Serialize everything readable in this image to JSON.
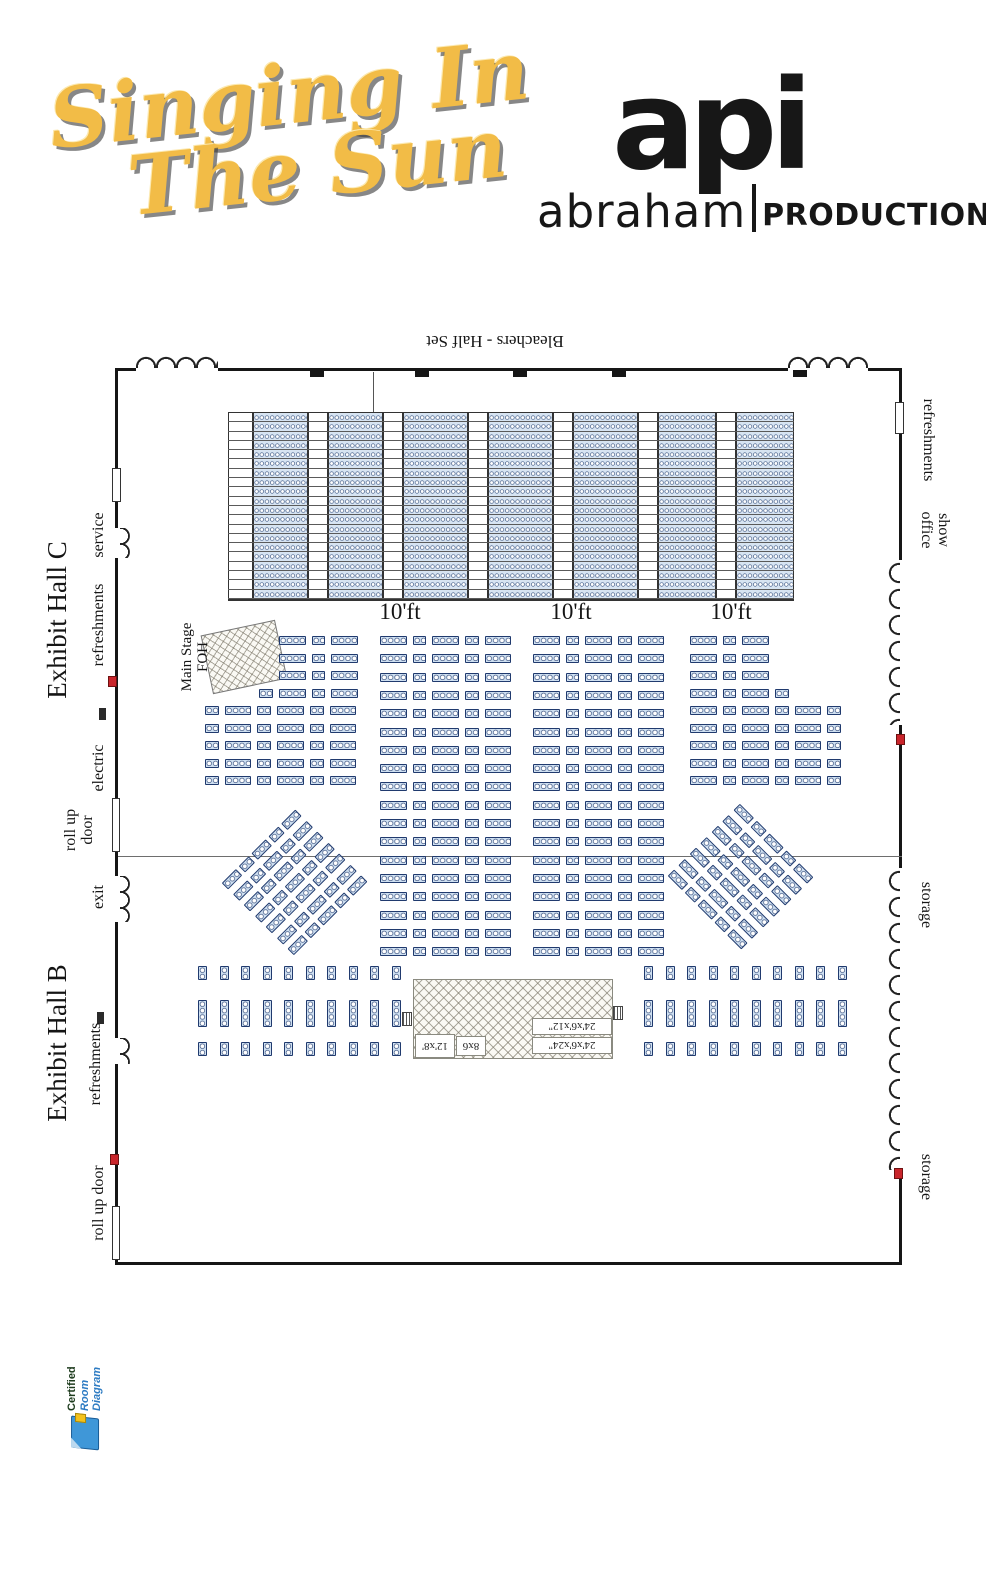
{
  "header": {
    "title1": "Singing In",
    "title2": "The Sun",
    "api": "api",
    "abraham": "abraham",
    "productions": "PRODUCTIONS"
  },
  "plan": {
    "bleachers_label": "Bleachers - Half Set",
    "aisles": [
      "10'ft",
      "10'ft",
      "10'ft"
    ],
    "halls": {
      "c": "Exhibit Hall C",
      "b": "Exhibit Hall B"
    },
    "left": {
      "service": "service",
      "refreshments_c": "refreshments",
      "electric": "electric",
      "rollup_c1": "roll up",
      "rollup_c2": "door",
      "exit": "exit",
      "refreshments_b": "refreshments",
      "rollup_b": "roll up door"
    },
    "right": {
      "refreshments": "refreshments",
      "show": "show",
      "office": "office",
      "storage1": "storage",
      "storage2": "storage"
    },
    "foh1": "Main Stage",
    "foh2": "FOH",
    "stage": {
      "s1": "24'x6'x12\"",
      "s2": "24'x6'x24\"",
      "s3": "8x6",
      "s4": "12'x8'"
    }
  },
  "badge": {
    "l1": "Certified",
    "l2": "Room Diagram"
  },
  "colors": {
    "gold": "#f2bc47",
    "logo_black": "#171717",
    "seat_fill": "#cfe0f1",
    "seat_line": "#203a6e",
    "wall": "#161616",
    "red_marker": "#c9252b",
    "badge_blue": "#2e7cc3"
  },
  "seating": {
    "pitch": 6.4,
    "bleachers": {
      "x": 228,
      "y": 412,
      "w": 566,
      "rows": 20,
      "rowH": 9.3,
      "cols": [
        {
          "t": "stairs",
          "w": 25
        },
        {
          "t": "seats",
          "w": 55
        },
        {
          "t": "aisle",
          "w": 20
        },
        {
          "t": "seats",
          "w": 55
        },
        {
          "t": "aisle",
          "w": 20
        },
        {
          "t": "seats",
          "w": 65
        },
        {
          "t": "aisle",
          "w": 20
        },
        {
          "t": "seats",
          "w": 65
        },
        {
          "t": "aisle",
          "w": 20
        },
        {
          "t": "seats",
          "w": 65
        },
        {
          "t": "aisle",
          "w": 20
        },
        {
          "t": "seats",
          "w": 58
        },
        {
          "t": "aisle",
          "w": 20
        },
        {
          "t": "seats",
          "w": 58
        }
      ]
    },
    "blocks": [
      {
        "type": "rows",
        "x": 205,
        "y": 636,
        "w": 153,
        "h": 149,
        "step": 17.5,
        "gap": 6,
        "rows": [
          {
            "n": 3,
            "a": "r",
            "c": [
              4,
              2,
              4
            ]
          },
          {
            "n": 1,
            "a": "r",
            "c": [
              2,
              4,
              2,
              4
            ]
          },
          {
            "n": 5,
            "a": "l",
            "c": [
              2,
              4,
              2,
              4,
              2,
              4
            ]
          }
        ]
      },
      {
        "type": "rows",
        "x": 380,
        "y": 636,
        "w": 123,
        "h": 320,
        "step": 18.3,
        "gap": 6,
        "rows": [
          {
            "n": 18,
            "a": "l",
            "c": [
              4,
              2,
              4,
              2,
              4
            ]
          }
        ]
      },
      {
        "type": "rows",
        "x": 533,
        "y": 636,
        "w": 123,
        "h": 320,
        "step": 18.3,
        "gap": 6,
        "rows": [
          {
            "n": 18,
            "a": "l",
            "c": [
              4,
              2,
              4,
              2,
              4
            ]
          }
        ]
      },
      {
        "type": "rows",
        "x": 690,
        "y": 636,
        "w": 153,
        "h": 149,
        "step": 17.5,
        "gap": 6,
        "rows": [
          {
            "n": 3,
            "a": "l",
            "c": [
              4,
              2,
              4
            ]
          },
          {
            "n": 1,
            "a": "l",
            "c": [
              4,
              2,
              4,
              2
            ]
          },
          {
            "n": 5,
            "a": "l",
            "c": [
              4,
              2,
              4,
              2,
              4,
              2
            ]
          }
        ]
      },
      {
        "type": "rows",
        "x": 242,
        "y": 830,
        "w": 108,
        "h": 102,
        "step": 15.5,
        "gap": 4,
        "rot": -45,
        "rows": [
          {
            "n": 7,
            "a": "l",
            "c": [
              3,
              2,
              3,
              2,
              3
            ]
          }
        ]
      },
      {
        "type": "rows",
        "x": 688,
        "y": 827,
        "w": 108,
        "h": 102,
        "step": 15.5,
        "gap": 4,
        "rot": 45,
        "rows": [
          {
            "n": 7,
            "a": "l",
            "c": [
              3,
              2,
              3,
              2,
              3
            ]
          }
        ]
      },
      {
        "type": "vrows",
        "x": 198,
        "y": 966,
        "n": 10,
        "seats": 2,
        "px": 21.5
      },
      {
        "type": "vrows",
        "x": 198,
        "y": 1000,
        "n": 10,
        "seats": 4,
        "px": 21.5
      },
      {
        "type": "vrows",
        "x": 198,
        "y": 1042,
        "n": 10,
        "seats": 2,
        "px": 21.5
      },
      {
        "type": "vrows",
        "x": 644,
        "y": 966,
        "n": 10,
        "seats": 2,
        "px": 21.5
      },
      {
        "type": "vrows",
        "x": 644,
        "y": 1000,
        "n": 10,
        "seats": 4,
        "px": 21.5
      },
      {
        "type": "vrows",
        "x": 644,
        "y": 1042,
        "n": 10,
        "seats": 2,
        "px": 21.5
      }
    ]
  }
}
